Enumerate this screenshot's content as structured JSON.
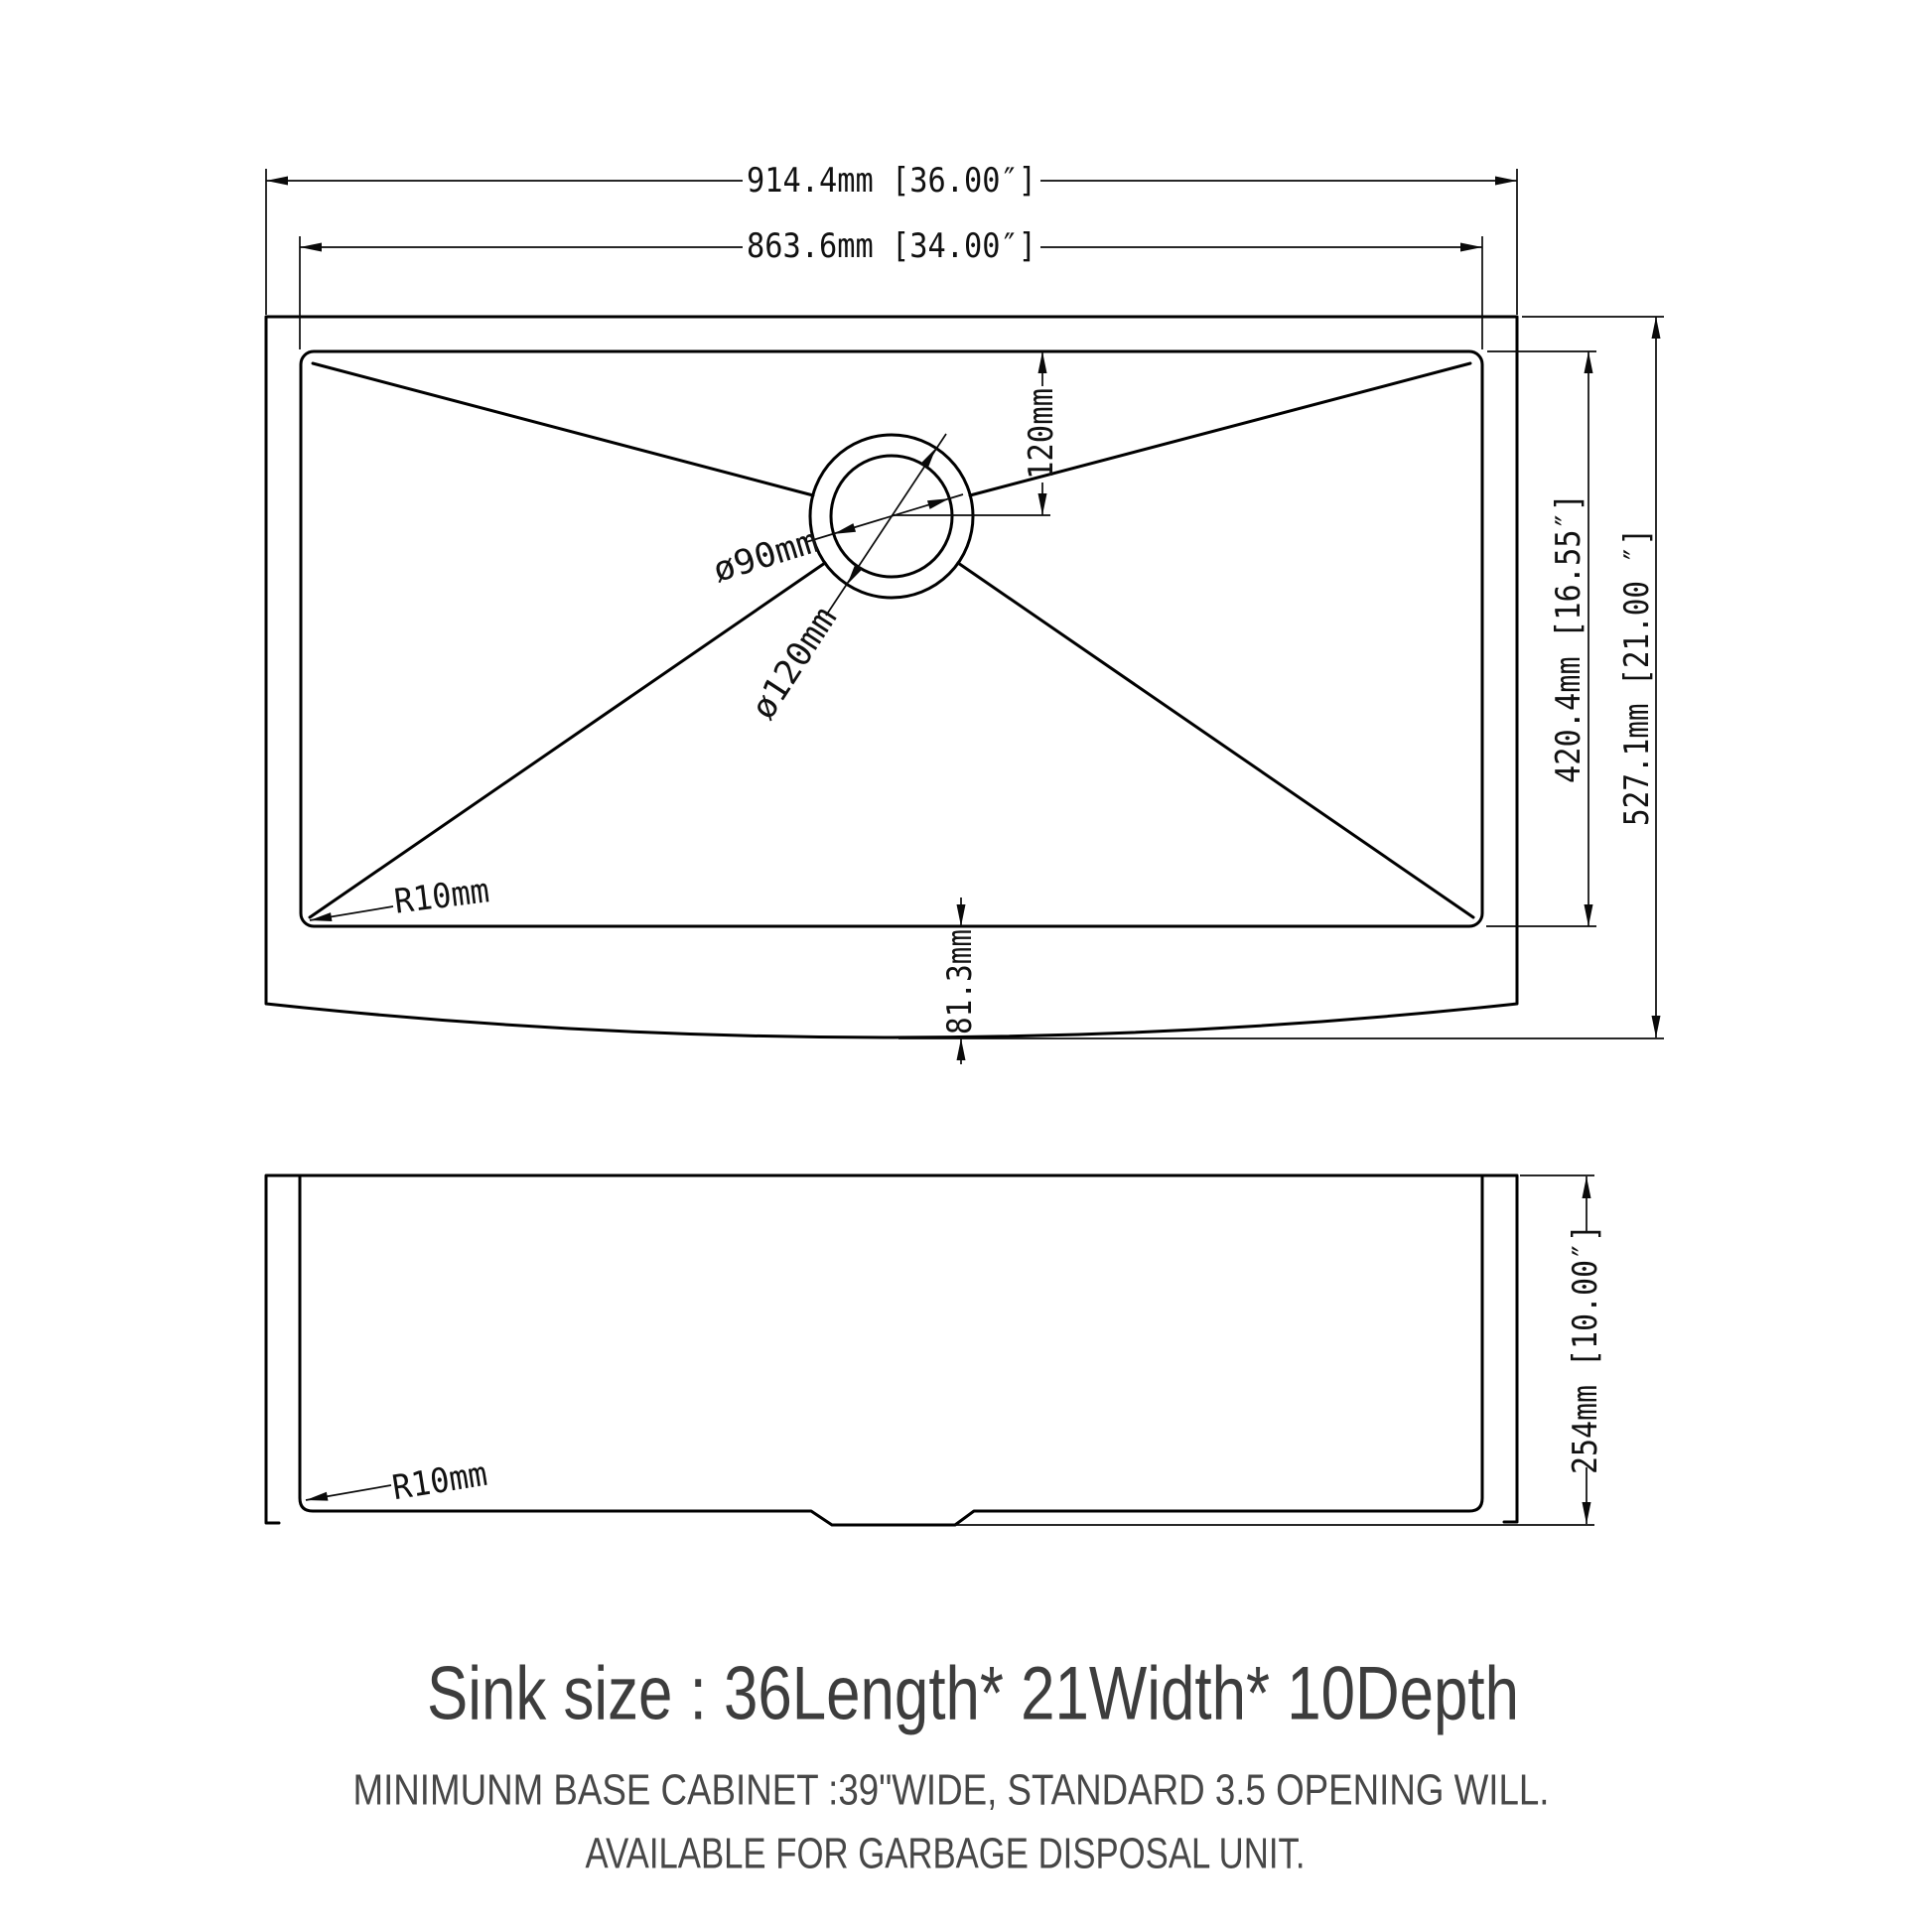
{
  "drawing": {
    "type": "technical-dimension-diagram",
    "subject": "farmhouse apron kitchen sink",
    "line_color": "#000000",
    "text_color": "#3d3d3d",
    "background": "#ffffff"
  },
  "top_view": {
    "dim_overall_width": "914.4mm [36.00″]",
    "dim_bowl_width": "863.6mm [34.00″]",
    "dim_bowl_depth": "420.4mm [16.55″]",
    "dim_overall_depth": "527.1mm [21.00 ″]",
    "dim_drain_offset": "120mm",
    "dim_drain_inner_diameter": "ø90mm",
    "dim_drain_outer_diameter": "ø120mm",
    "dim_corner_radius": "R10mm",
    "dim_apron_depth": "81.3mm"
  },
  "side_view": {
    "dim_height": "254mm [10.00″]",
    "dim_corner_radius": "R10mm"
  },
  "caption": {
    "title": "Sink size :  36Length* 21Width* 10Depth",
    "note_line1": "MINIMUNM BASE CABINET :39\"WIDE,  STANDARD 3.5 OPENING WILL.",
    "note_line2": "AVAILABLE FOR GARBAGE DISPOSAL UNIT."
  }
}
